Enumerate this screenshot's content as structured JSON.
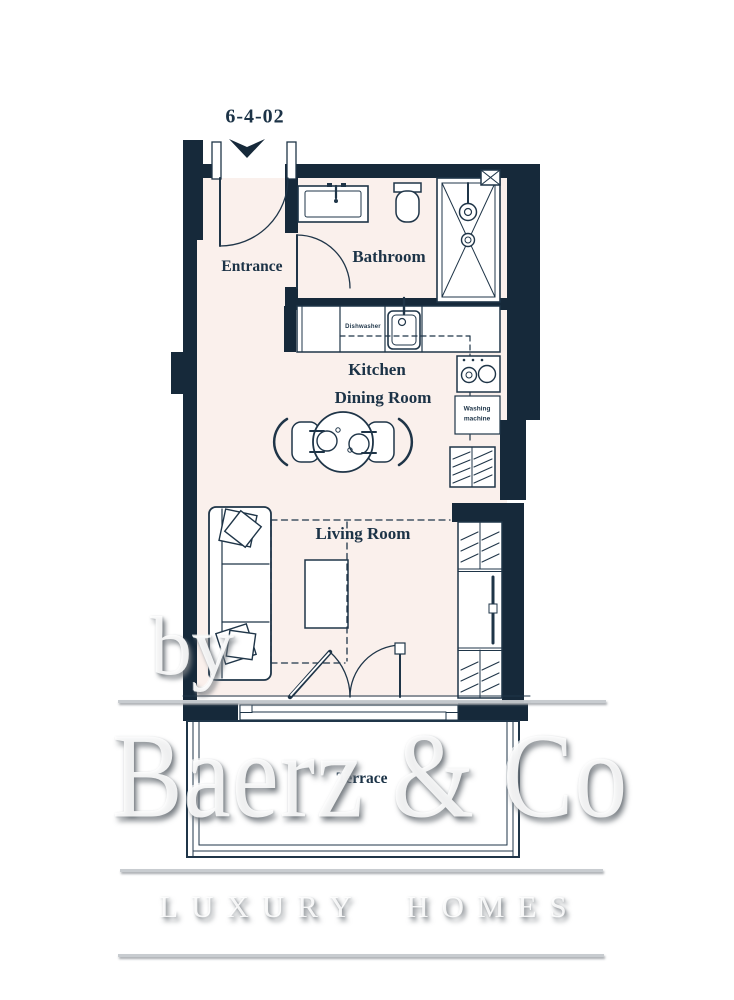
{
  "plan": {
    "labels": {
      "unit_number": "6-4-02",
      "entrance": "Entrance",
      "bathroom": "Bathroom",
      "kitchen": "Kitchen",
      "dining_room": "Dining Room",
      "living_room": "Living Room",
      "terrace": "Terrace",
      "dishwasher": "Dishwasher",
      "washing_machine_line1": "Washing",
      "washing_machine_line2": "machine"
    },
    "colors": {
      "wall": "#16293a",
      "floor": "#faf0ec",
      "stroke": "#1f3548",
      "label_text": "#1c3347"
    }
  },
  "watermark": {
    "prefix": "by",
    "brand": "Baerz & Co",
    "tagline": "LUXURY HOMES"
  }
}
